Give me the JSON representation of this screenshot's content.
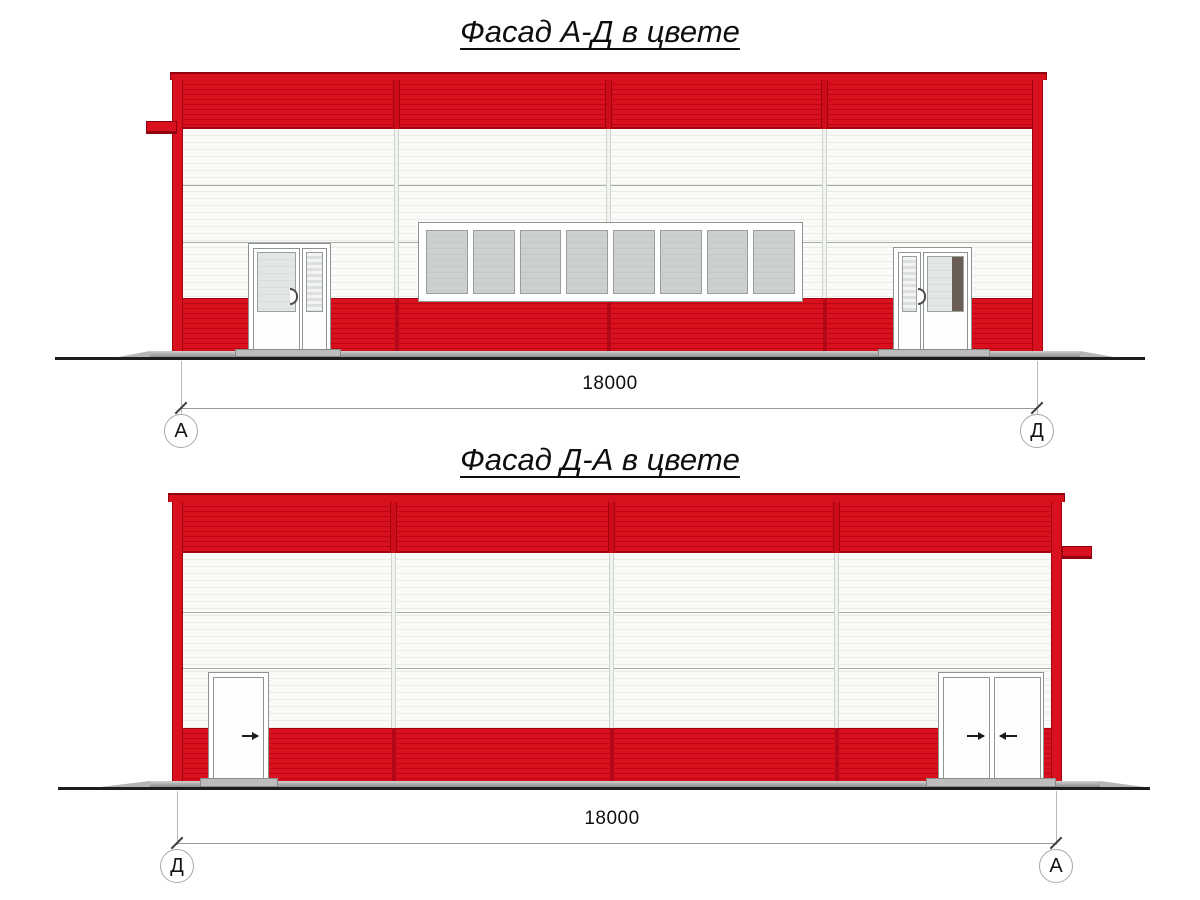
{
  "facade_top": {
    "title": "Фасад А-Д в цвете",
    "dimension_label": "18000",
    "axis_left_label": "А",
    "axis_right_label": "Д",
    "window_pane_count": 8
  },
  "facade_bottom": {
    "title": "Фасад Д-А в цвете",
    "dimension_label": "18000",
    "axis_left_label": "Д",
    "axis_right_label": "А"
  },
  "colors": {
    "facade_red": "#d9111f",
    "facade_red_dark": "#b30513",
    "panel_white": "#fafbf9",
    "glass_gray": "#ccd0cd",
    "door_dark_pane": "#6b5e54",
    "ground_line": "#1d1d1d",
    "dimension_gray": "#9b9b9b"
  }
}
